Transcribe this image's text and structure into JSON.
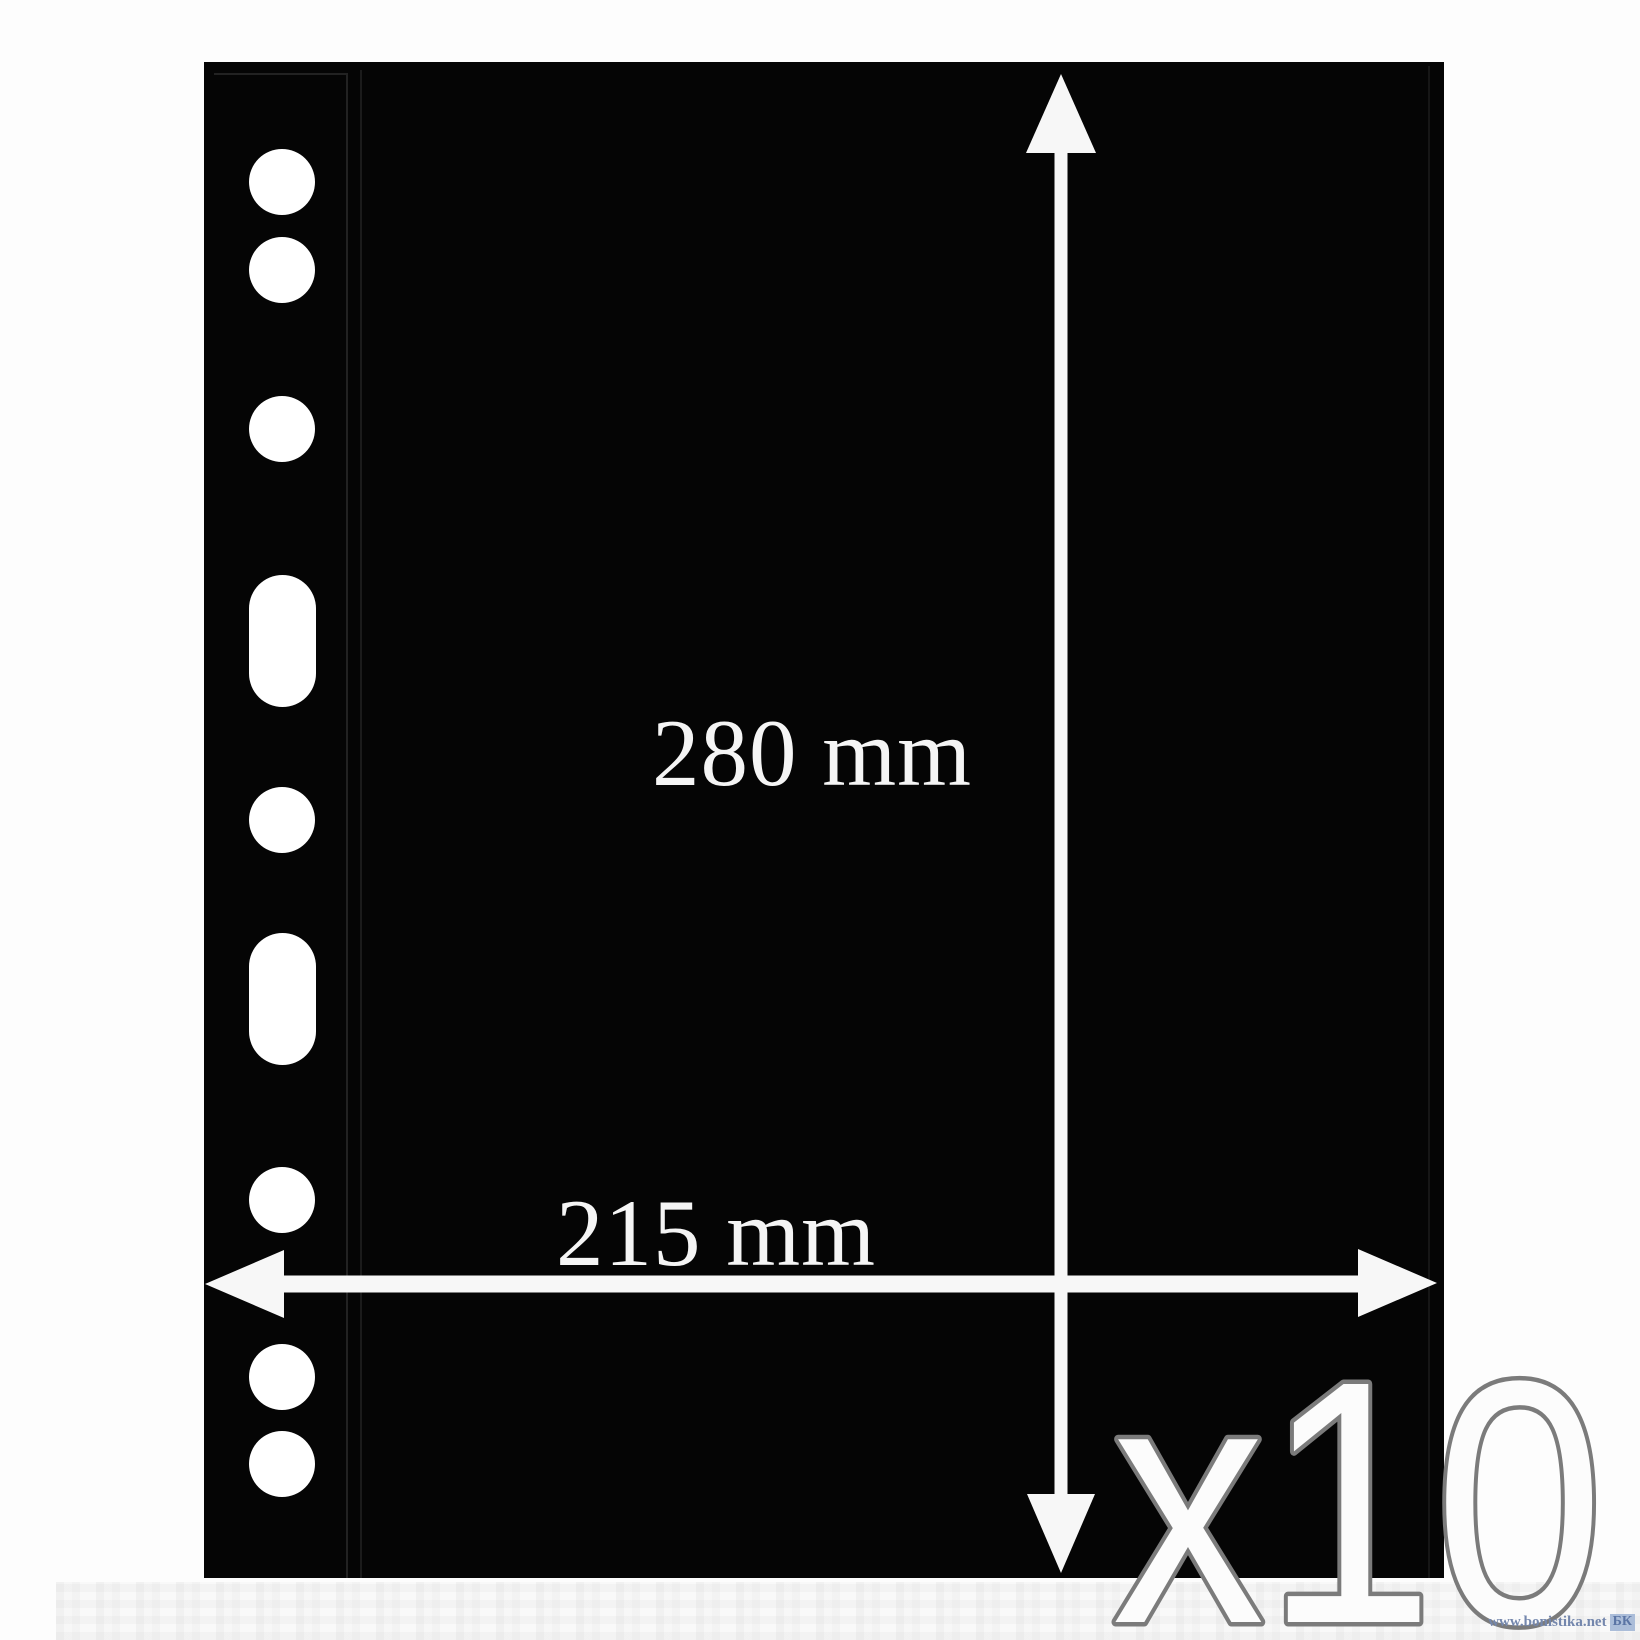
{
  "product": {
    "height_label": "280 mm",
    "width_label": "215 mm",
    "quantity_label": "x10"
  },
  "sheet": {
    "color": "#050505",
    "holes": {
      "cx": 282,
      "radius": 33,
      "slot_width": 67,
      "items": [
        {
          "shape": "circle",
          "cy": 182
        },
        {
          "shape": "circle",
          "cy": 270
        },
        {
          "shape": "circle",
          "cy": 429
        },
        {
          "shape": "slot",
          "top": 575,
          "height": 132
        },
        {
          "shape": "circle",
          "cy": 820
        },
        {
          "shape": "slot",
          "top": 933,
          "height": 132
        },
        {
          "shape": "circle",
          "cy": 1200
        },
        {
          "shape": "circle",
          "cy": 1377
        },
        {
          "shape": "circle",
          "cy": 1464
        }
      ]
    }
  },
  "annotation": {
    "arrow_color": "#f7f7f7",
    "label_color": "#f5f5f5",
    "quantity_fill": "#fcfcfc",
    "quantity_outline": "#7b7b7b"
  },
  "watermark": {
    "text": "www.bonistika.net",
    "badge": "БК"
  }
}
